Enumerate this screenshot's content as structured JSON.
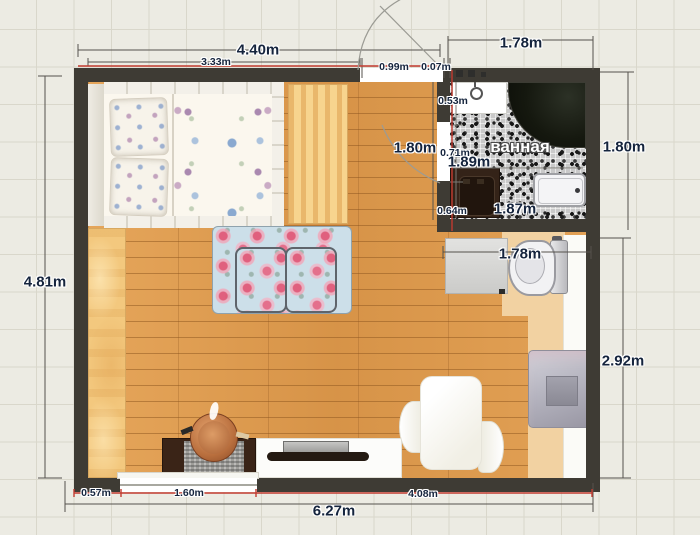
{
  "plan": {
    "room_label": "ванная",
    "dimensions": {
      "top_total": "4.40m",
      "top_inner": "3.33m",
      "door_offset": "0.99m",
      "door_gap": "0.07m",
      "bath_top": "1.78m",
      "bath_left_outer": "1.80m",
      "bath_right_outer": "1.80m",
      "sink_depth": "0.53m",
      "bath_door_width": "0.71m",
      "bath_inner_width": "1.89m",
      "washer_width": "0.64m",
      "bathtub_width": "1.87m",
      "toilet_span": "1.78m",
      "left_total": "4.81m",
      "right_lower": "2.92m",
      "bottom_total": "6.27m",
      "bottom_left": "0.57m",
      "bottom_window": "1.60m",
      "bottom_right": "4.08m"
    },
    "colors": {
      "wall": "#3e3b34",
      "floor_wood": "#dd9a4d",
      "light_wood": "#f3c87e",
      "selection_red": "#c23b30",
      "dimension_text": "#15243d",
      "grid_background": "#ecebe3"
    }
  }
}
